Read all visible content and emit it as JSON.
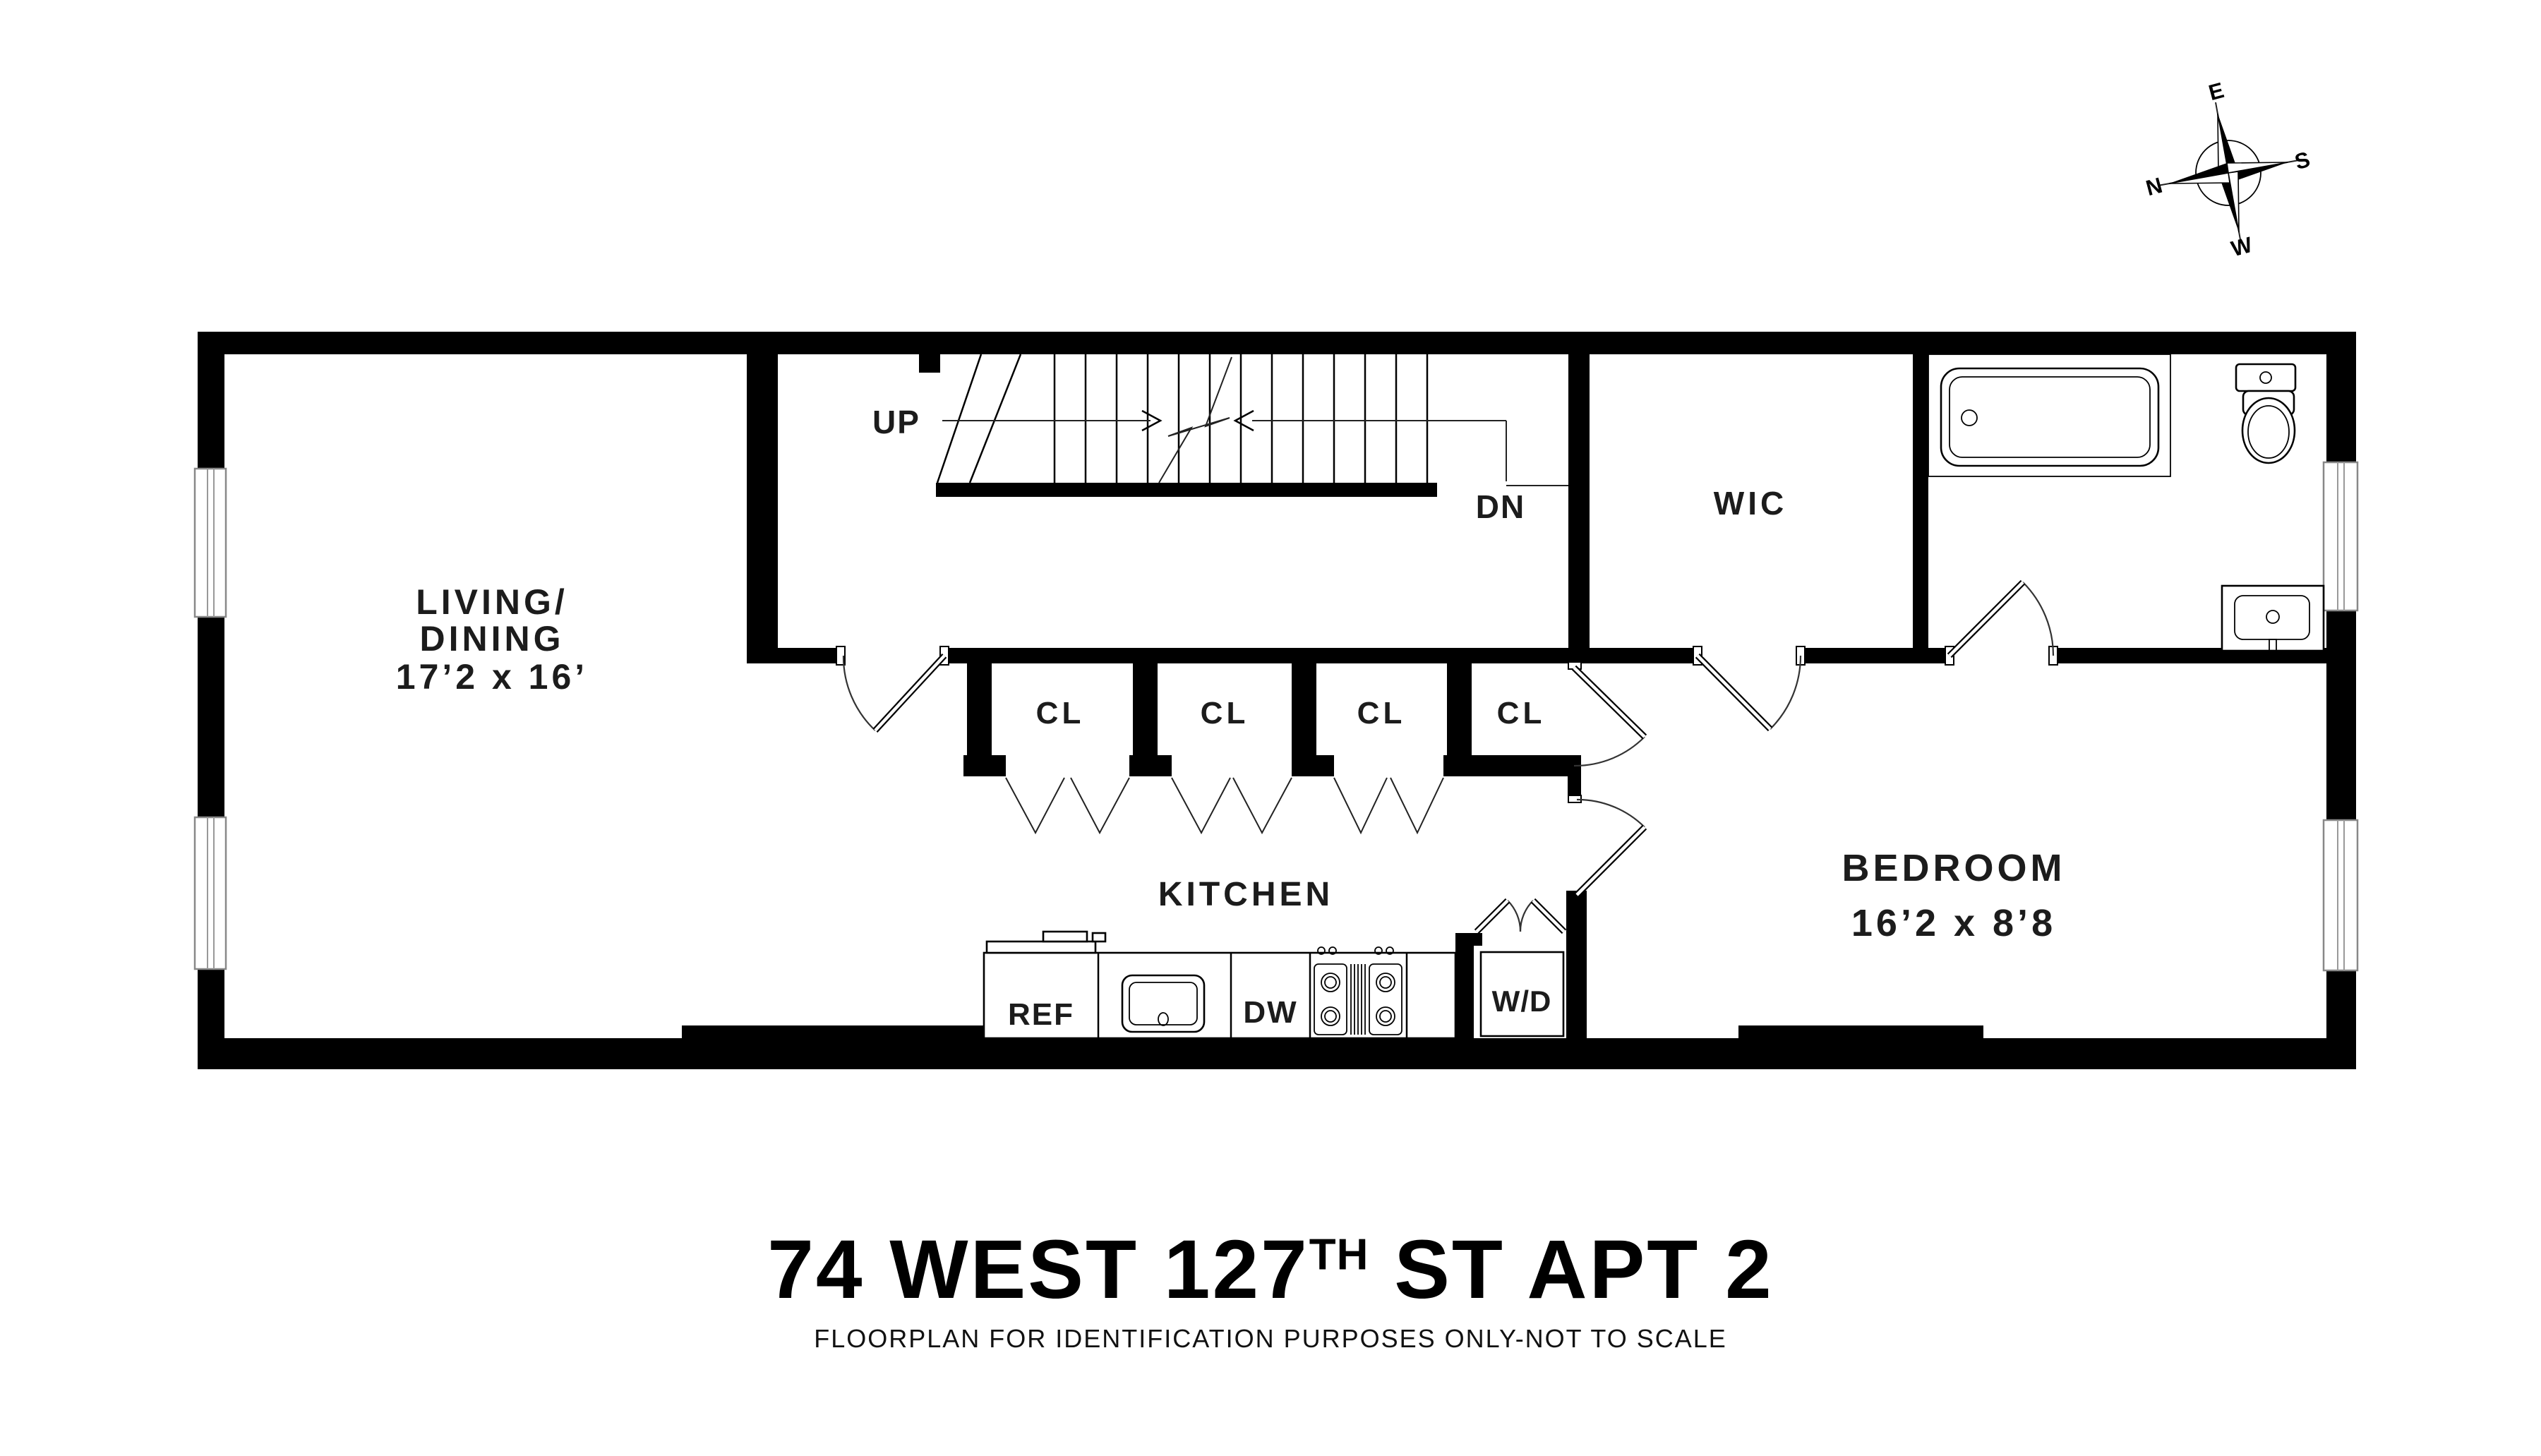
{
  "title": {
    "part1": "74 WEST 127",
    "sup": "TH",
    "part2": " ST APT 2",
    "subtitle": "FLOORPLAN FOR IDENTIFICATION PURPOSES ONLY-NOT TO SCALE"
  },
  "compass": {
    "n": "N",
    "e": "E",
    "s": "S",
    "w": "W"
  },
  "rooms": {
    "living": {
      "line1": "LIVING/",
      "line2": "DINING",
      "dims": "17’2 x 16’"
    },
    "kitchen": {
      "label": "KITCHEN"
    },
    "bedroom": {
      "label": "BEDROOM",
      "dims": "16’2 x 8’8"
    },
    "wic": {
      "label": "WIC"
    },
    "closets": [
      {
        "label": "CL"
      },
      {
        "label": "CL"
      },
      {
        "label": "CL"
      },
      {
        "label": "CL"
      }
    ],
    "stairs": {
      "up": "UP",
      "dn": "DN"
    }
  },
  "appliances": {
    "ref": "REF",
    "dw": "DW",
    "wd": "W/D"
  },
  "colors": {
    "wall": "#000000",
    "background": "#ffffff",
    "frame_gray": "#888888"
  }
}
